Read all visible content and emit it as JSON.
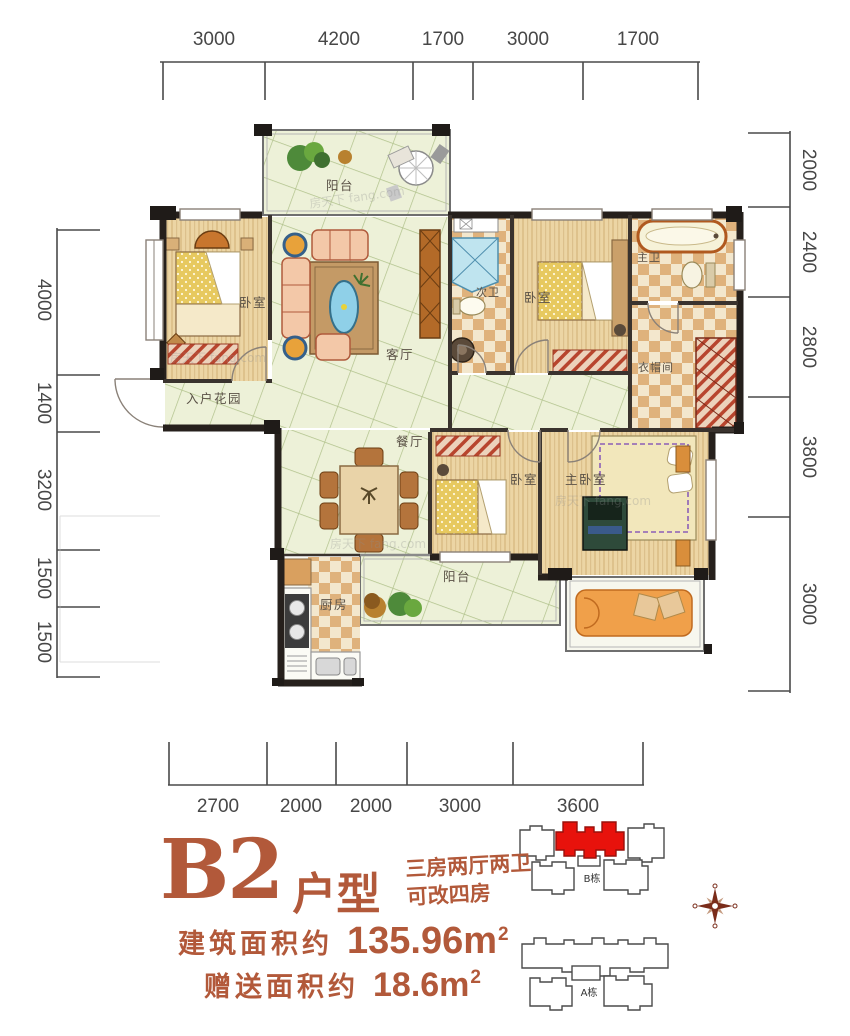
{
  "dimensions": {
    "top": [
      "3000",
      "4200",
      "1700",
      "3000",
      "1700"
    ],
    "bottom": [
      "2700",
      "2000",
      "2000",
      "3000",
      "3600"
    ],
    "left": [
      "4000",
      "1400",
      "3200",
      "1500",
      "1500"
    ],
    "right": [
      "2000",
      "2400",
      "2800",
      "3800",
      "3000"
    ]
  },
  "plan": {
    "rooms": {
      "balcony_top": "阳台",
      "bedroom1": "卧室",
      "living": "客厅",
      "entry_garden": "入户花园",
      "bath2": "次卫",
      "bedroom2": "卧室",
      "master_bath": "主卫",
      "cloakroom": "衣帽间",
      "dining": "餐厅",
      "bedroom3": "卧室",
      "master_bedroom": "主卧室",
      "kitchen": "厨房",
      "balcony_bottom": "阳台"
    },
    "watermark": "房天下 fang.com"
  },
  "info": {
    "unit_code": "B2",
    "unit_suffix": "户型",
    "desc_line1": "三房两厅两卫",
    "desc_line2": "可改四房",
    "area_label1": "建筑面积约",
    "area_value1": "135.96m",
    "area_sup1": "2",
    "area_label2": "赠送面积约",
    "area_value2": "18.6m",
    "area_sup2": "2",
    "accent_color": "#b2593a"
  },
  "keyplan": {
    "b_label": "B栋",
    "a_label": "A栋",
    "highlight_color": "#e8120c"
  }
}
